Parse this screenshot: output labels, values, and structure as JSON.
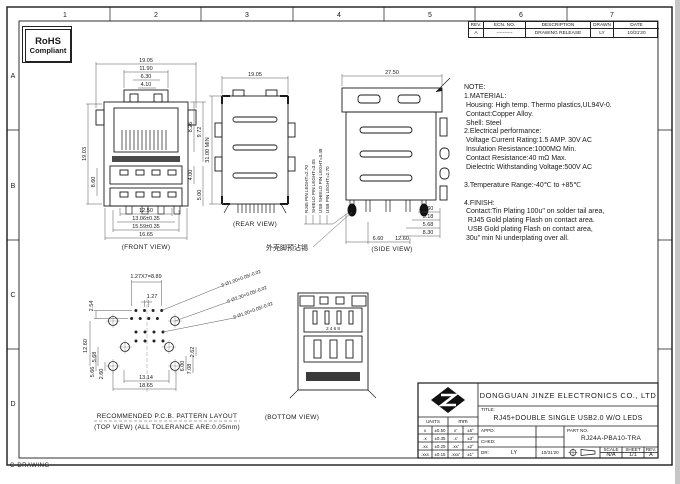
{
  "sheet": {
    "corner_note": "C-DRAWING",
    "grid": {
      "top": [
        "1",
        "2",
        "3",
        "4",
        "5",
        "6",
        "7"
      ],
      "left": [
        "A",
        "B",
        "C",
        "D"
      ]
    },
    "rohs": {
      "line1": "RoHS",
      "line2": "Compliant"
    }
  },
  "revision_table": {
    "headers": [
      "REV.",
      "ECN. NO.",
      "DESCRIPTION",
      "DRAWN",
      "DATE"
    ],
    "row": [
      "A",
      "----------",
      "DRAWING RELEASE",
      "LY",
      "10/31'20"
    ]
  },
  "notes": {
    "heading": "NOTE:",
    "lines": [
      "1.MATERIAL:",
      " Housing: High temp. Thermo plastics,UL94V-0.",
      " Contact:Copper Alloy.",
      " Shell: Steel",
      "2.Electrical performance:",
      " Voltage Current Rating:1.5 AMP. 30V AC",
      " Insulation Resistance:1000MΩ Min.",
      " Contact Resistance:40 mΩ Max.",
      " Dielectric Withstanding Voltage:500V AC",
      "",
      "3.Temperature Range:-40℃ to +85℃",
      "",
      "4.FINISH:",
      " Contact:Tin Plating 100u\" on solder tail area,",
      "  RJ45 Gold plating Flash on contact area.",
      "  USB Gold plating Flash on contact area,",
      " 30u\" min Ni underplating over all."
    ]
  },
  "front_view": {
    "label": "(FRONT VIEW)",
    "dims": {
      "top1": "19.05",
      "top2": "11.90",
      "top3": "6.30",
      "top4": "4.10",
      "right1": "8.26",
      "right2": "9.72",
      "right3": "4.00",
      "right4": "5.00",
      "left1": "19.03",
      "left2": "8.60",
      "bot1": "12.50",
      "bot2": "13.06±0.35",
      "bot3": "15.59±0.35",
      "bot4": "16.65"
    }
  },
  "rear_view": {
    "label": "(REAR VIEW)",
    "dims": {
      "top": "19.05",
      "left": "31.00 MIN"
    }
  },
  "pin_labels": [
    "RJ45 PIN LEGHT=2.70",
    "SHIELD PIN LEGHT=3.05",
    "USB SHIELD PIN LEGHT=3.48",
    "USB PIN LEGHT=2.70"
  ],
  "side_view": {
    "label": "(SIDE VIEW)",
    "callout": "外壳脚预沾锡",
    "dims": {
      "top": "27.50",
      "r1": "2.60",
      "r2": "5.18",
      "r3": "5.68",
      "r4": "8.30",
      "b1": "6.60",
      "b2": "12.60"
    }
  },
  "pcb_layout": {
    "caption1": "RECOMMENDED P.C.B. PATTERN LAYOUT",
    "caption2": "(TOP VIEW) (ALL TOLERANCE ARE:0.05mm)",
    "dims": {
      "pitch": "1.27X7=8.89",
      "row_gap": "2.54",
      "col_gap": "1.27",
      "l1": "12.60",
      "l2": "5.68",
      "l3": "5.66",
      "l4": "2.60",
      "r1": "2.62",
      "r2": "6.00",
      "r3": "7.08",
      "b1": "13.14",
      "b2": "18.65"
    },
    "callouts": [
      "8-Ø1.00+0.05/-0.02",
      "6-Ø2.30+0.05/-0.02",
      "8-Ø1.00+0.05/-0.02"
    ]
  },
  "bottom_view": {
    "label": "(BOTTOM VIEW)",
    "pin_numbers": "2 4 6 8"
  },
  "title_block": {
    "company": "DONGGUAN JINZE ELECTRONICS CO., LTD",
    "title_label": "TITLE:",
    "title": "RJ45+DOUBLE SINGLE USB2.0 W/O LEDS",
    "units_label": "UNITS",
    "units_value": "mm",
    "tolerances": [
      [
        "x",
        "±0.50",
        "x'",
        "±5°"
      ],
      [
        ".x",
        "±0.35",
        ".x'",
        "±3°"
      ],
      [
        ".xx",
        "±0.25",
        ".xx'",
        "±2°"
      ],
      [
        ".xxx",
        "±0.15",
        ".xxx'",
        "±1°"
      ]
    ],
    "appd_label": "APPD:",
    "chkd_label": "CHKD:",
    "dr_label": "DR:",
    "dr_value": "LY",
    "dr_date": "10/31'20",
    "part_label": "PART NO.",
    "part_no": "RJ24A-PBA10-TRA",
    "scale_label": "SCALE",
    "scale": "N/A",
    "sheet_label": "SHEET",
    "sheet": "1/1",
    "rev_label": "REV.",
    "rev": "A"
  }
}
